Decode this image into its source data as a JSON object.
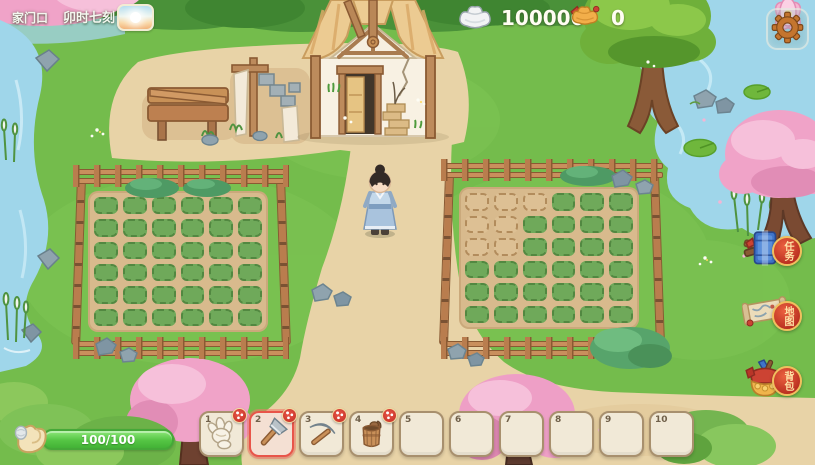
{
  "header": {
    "location": "家门口",
    "time": "卯时七刻",
    "weather_icon": "sunrise-icon",
    "currencies": [
      {
        "id": "silver",
        "icon": "silver-ingot-icon",
        "value": "100000"
      },
      {
        "id": "gold",
        "icon": "gold-ingot-icon",
        "value": "0"
      }
    ],
    "settings_icon": "gear-icon"
  },
  "side_menu": [
    {
      "id": "quest",
      "icon": "quest-book-icon",
      "label": "任务"
    },
    {
      "id": "map",
      "icon": "map-scroll-icon",
      "label": "地图"
    },
    {
      "id": "backpack",
      "icon": "backpack-icon",
      "label": "背包"
    }
  ],
  "stamina": {
    "icon": "muscle-arm-icon",
    "value": "100/100"
  },
  "hotbar": [
    {
      "number": "1",
      "item": "glove",
      "selected": false,
      "badge": true
    },
    {
      "number": "2",
      "item": "axe",
      "selected": true,
      "badge": true
    },
    {
      "number": "3",
      "item": "pickaxe",
      "selected": false,
      "badge": true
    },
    {
      "number": "4",
      "item": "bucket",
      "selected": false,
      "badge": true
    },
    {
      "number": "5",
      "item": null,
      "selected": false,
      "badge": false
    },
    {
      "number": "6",
      "item": null,
      "selected": false,
      "badge": false
    },
    {
      "number": "7",
      "item": null,
      "selected": false,
      "badge": false
    },
    {
      "number": "8",
      "item": null,
      "selected": false,
      "badge": false
    },
    {
      "number": "9",
      "item": null,
      "selected": false,
      "badge": false
    },
    {
      "number": "10",
      "item": null,
      "selected": false,
      "badge": false
    }
  ],
  "fields": {
    "left": {
      "rows": 6,
      "cols": 6,
      "tilled_indices": []
    },
    "right": {
      "rows": 6,
      "cols": 6,
      "tilled_indices": [
        0,
        1,
        2,
        6,
        7,
        12,
        13
      ]
    }
  },
  "palette": {
    "grass": "#74bc4c",
    "path_tan": "#e8d3a7",
    "water": "#9fd6ea",
    "fence_brown": "#b97d4e",
    "accent_red": "#d5372e",
    "selected_slot": "#e8554a",
    "stamina_green": "#55c544",
    "badge_gold_border": "#f0bf5e",
    "sakura_pink": "#f0a3c8"
  }
}
